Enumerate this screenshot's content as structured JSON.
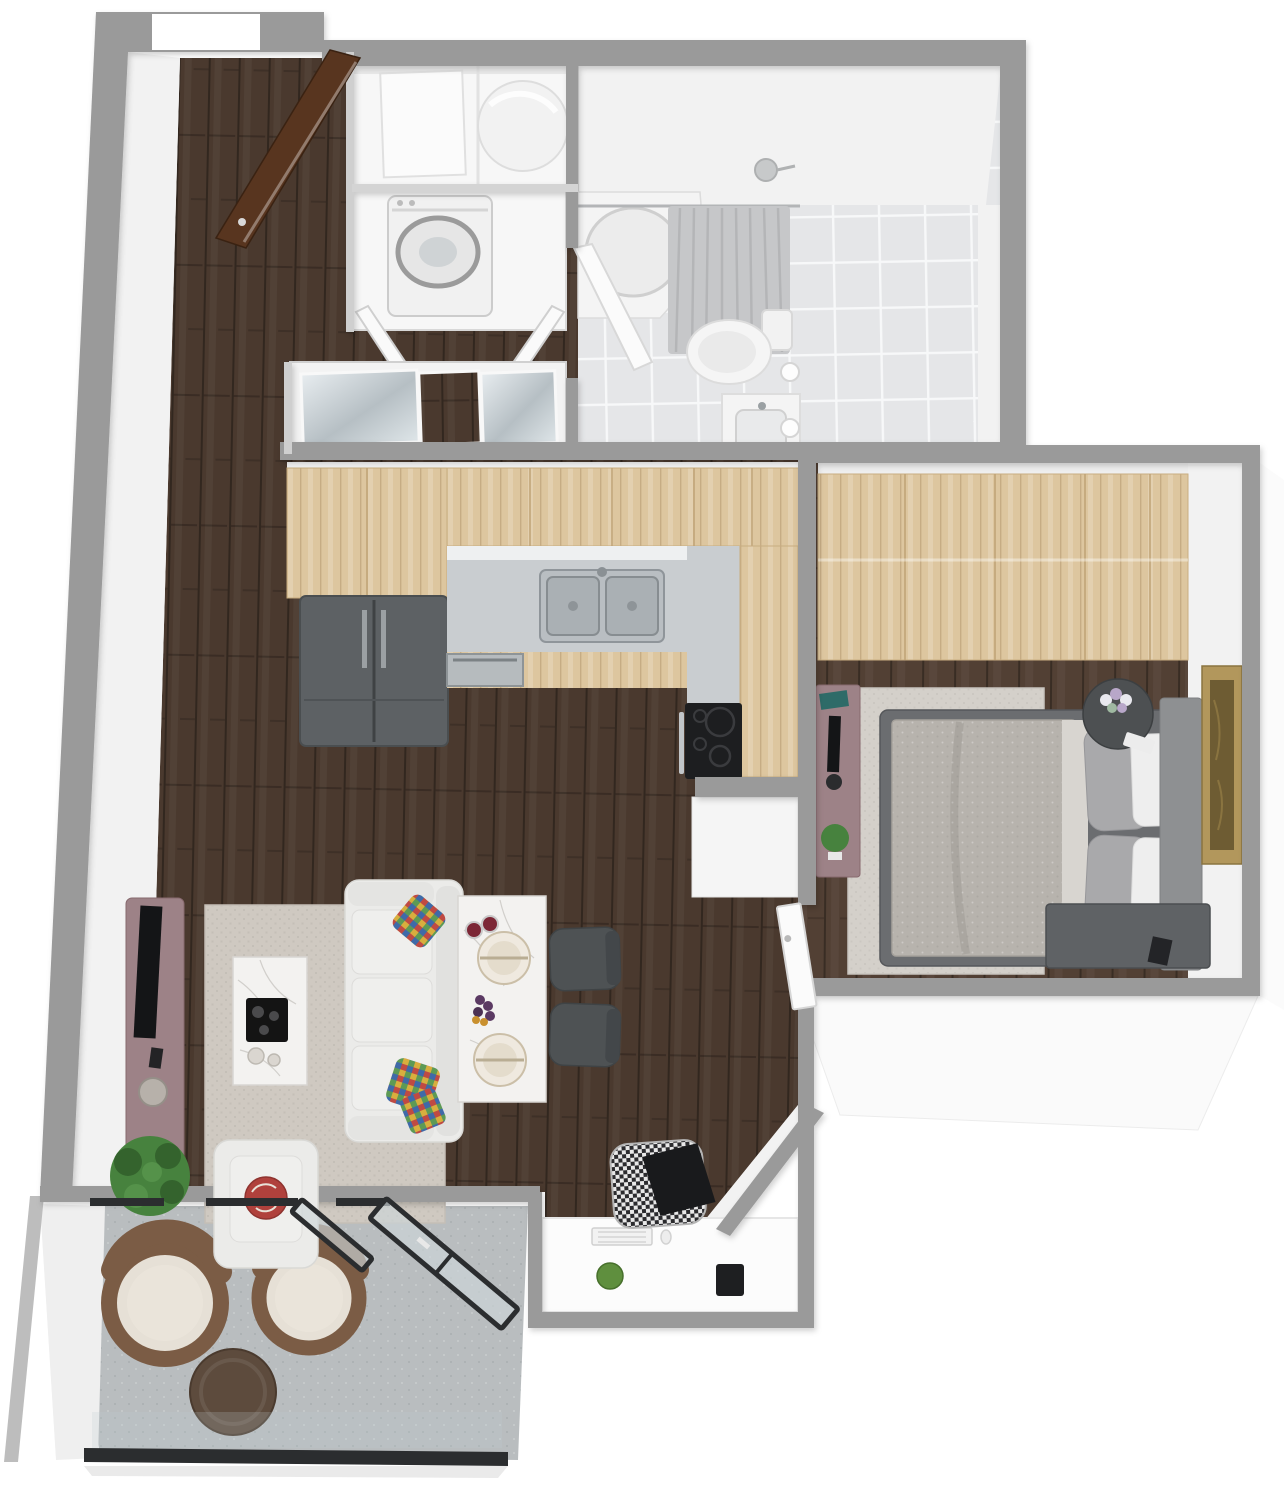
{
  "scene": {
    "title": "3D top-down rendered floor plan of a one-bedroom apartment with balcony",
    "background": "#ffffff"
  },
  "palette": {
    "wall": "#9a9a9a",
    "wall_face": "#f2f2f2",
    "wood_dark": "#4a392e",
    "wood_bed": "#524034",
    "wood_light": "#ddc69f",
    "counter": "#c9cdd0",
    "steel": "#aab0b4",
    "fridge": "#5d6164",
    "cooktop": "#1d1e20",
    "tile": "#e5e6e8",
    "fixture": "#f4f4f4",
    "curtain": "#c6c7c9",
    "rug": "#cfc9c1",
    "rug_bed": "#d4d0ca",
    "sofa": "#ebebe9",
    "marble": "#f3f2f0",
    "chair_dark": "#4e5254",
    "mauve": "#9d8287",
    "tv": "#141517",
    "plant": "#47823e",
    "duvet": "#b7b3ad",
    "pillow_gray": "#a9a9ab",
    "pillow_white": "#eeeeee",
    "bed_frame": "#6b6d70",
    "headboard": "#8e9092",
    "nightstand": "#4d5052",
    "bench": "#5f6265",
    "gold": "#b2975c",
    "gold_inner": "#6e5c33",
    "balcony": "#b9bdbf",
    "wicker": "#7b5c45",
    "cushion": "#e6e0d6",
    "ottoman": "#5d4b3d",
    "glass_frame": "#2b2d2f",
    "glass": "#ccd6d8",
    "door_brown": "#58351f"
  },
  "rooms": {
    "entry": {
      "label": "Entry hall",
      "furniture": {
        "front_door": "Open wooden front door",
        "floor": "Dark hardwood floor"
      }
    },
    "utility": {
      "label": "Utility closet",
      "furniture": {
        "water_heater": "Round water heater",
        "storage_box": "White storage box"
      }
    },
    "laundry": {
      "label": "Laundry closet",
      "furniture": {
        "washer_dryer": "Stacked front-load washer dryer",
        "doors": "Open double doors"
      }
    },
    "hall_closet": {
      "label": "Hallway closet",
      "furniture": {
        "mirror_doors": "Mirrored sliding doors with wood panel"
      }
    },
    "bathroom": {
      "label": "Bathroom",
      "furniture": {
        "tub": "Corner soaking tub",
        "curtain": "Shower curtain",
        "toilet": "Toilet",
        "vanity": "Vanity with sink",
        "door": "Bathroom door",
        "sconce": "Wall sconce lights"
      }
    },
    "kitchen": {
      "label": "Kitchen",
      "furniture": {
        "pantry": "Tall pantry cabinet",
        "fridge": "Double-door refrigerator",
        "wall_cabinets": "Light wood wall cabinets",
        "counter": "L-shaped countertop",
        "sink": "Double stainless sink",
        "dishwasher": "Dishwasher",
        "cooktop": "Black range cooktop"
      }
    },
    "living": {
      "label": "Living room",
      "furniture": {
        "tv_console": "Mauve TV console",
        "tv": "Television",
        "rug": "Light area rug",
        "coffee_table": "Marble coffee table with black tray",
        "sofa": "White three-seat sofa",
        "pillows": "Colorful accent pillows",
        "armchair": "White armchair with round pillow",
        "plant": "Potted green plant"
      }
    },
    "dining": {
      "label": "Dining area",
      "furniture": {
        "table": "Marble dining table with two place settings",
        "chairs": "Two dark upholstered chairs",
        "fruit": "Grapes and wine glasses"
      }
    },
    "workspace": {
      "label": "Work nook",
      "furniture": {
        "desk": "Built-in white desk",
        "keyboard": "Keyboard",
        "chair": "Patterned desk chair with black pillow",
        "pen_cup": "Black pen cup",
        "apple": "Green apple"
      }
    },
    "bedroom": {
      "label": "Bedroom",
      "furniture": {
        "wardrobe": "Light wood wardrobe wall",
        "bed": "Double bed with gray patterned duvet",
        "pillows": "Gray and white pillows",
        "headboard": "Gray headboard",
        "nightstand": "Round dark nightstand with flowers",
        "bench": "Dark bench at bed foot",
        "desk": "Mauve writing desk with monitor and plant",
        "artwork": "Gold framed artwork",
        "rug": "Light bedroom rug",
        "door": "White bedroom door"
      }
    },
    "balcony": {
      "label": "Balcony",
      "furniture": {
        "chairs": "Two round wicker lounge chairs",
        "ottoman": "Round dark ottoman table",
        "glass_doors": "Black framed sliding glass doors",
        "railing": "Glass railing with dark rail"
      }
    }
  }
}
